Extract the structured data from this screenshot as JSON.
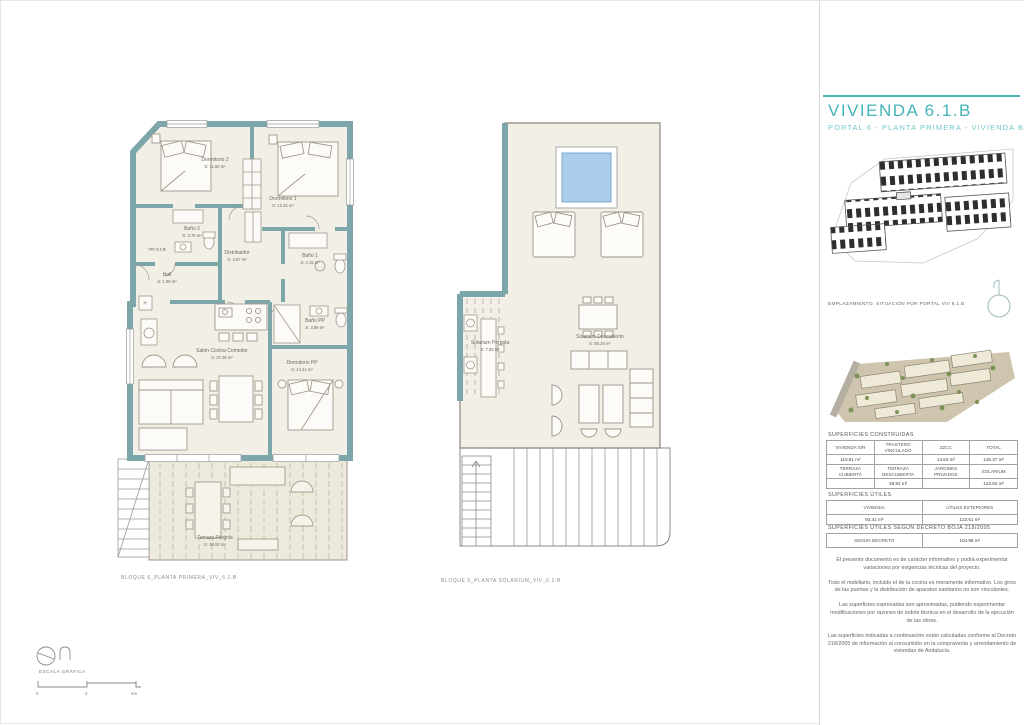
{
  "header": {
    "title": "VIVIENDA 6.1.B",
    "subtitle": "PORTAL 6 - PLANTA PRIMERA - VIVIENDA B"
  },
  "siteplan": {
    "caption": "EMPLAZAMIENTO. SITUACIÓN POR PORTAL VIV 6.1.B"
  },
  "areas": {
    "constructed_title": "SUPERFICIES CONSTRUIDAS",
    "table1": {
      "h": [
        "VIVIENDA S/R",
        "TRASTERO VINCULADO",
        "ZZCC",
        "TOTAL"
      ],
      "v": [
        "110.61 m²",
        "",
        "13.63 m²",
        "125.37 m²"
      ]
    },
    "table2": {
      "h": [
        "TERRAZA CUBIERTA",
        "TERRAZA DESCUBIERTA",
        "JARDINES PRIVADOS",
        "SOLARIUM"
      ],
      "v": [
        "",
        "38.92 m²",
        "",
        "122.82 m²"
      ]
    },
    "useful_title": "SUPERFICIES ÚTILES",
    "table3": {
      "h": [
        "VIVIENDA",
        "ÚTILES EXTERIORES"
      ],
      "v": [
        "93.41 m²",
        "123.61 m²"
      ]
    },
    "decree_title": "SUPERFICIES ÚTILES SEGÚN DECRETO BOJA 218/2005",
    "table4": {
      "h": [
        "SEGÚN DECRETO"
      ],
      "v": [
        "104.95 m²"
      ]
    }
  },
  "disclaimers": [
    "El presente documento es de carácter informativo y podrá experimentar variaciones por exigencias técnicas del proyecto.",
    "Todo el mobiliario, incluido el de la cocina es meramente informativo. Los giros de las puertas y la distribución de aparatos sanitarios no son vinculantes.",
    "Las superficies expresadas son aproximadas, pudiendo experimentar modificaciones por razones de índole técnica en el desarrollo de la ejecución de las obras.",
    "Las superficies indicadas a continuación están calculadas conforme al Decreto 218/2005 de información al consumidor en la compraventa y arrendamiento de viviendas de Andalucía."
  ],
  "plan_first": {
    "caption": "BLOQUE 6_PLANTA PRIMERA_VIV_6.1.B",
    "unit": "VIV. 6.1.B",
    "shaft": "H",
    "rooms": [
      {
        "name": "Dormitorio 2",
        "area": "S: 11.60 m²"
      },
      {
        "name": "Dormitorio 1",
        "area": "S: 12.34 m²"
      },
      {
        "name": "Baño 2",
        "area": "S: 3.76 m²"
      },
      {
        "name": "Baño 1",
        "area": "S: 4.15 m²"
      },
      {
        "name": "Distribuidor",
        "area": "S: 3.97 m²"
      },
      {
        "name": "Hall",
        "area": "S: 1.99 m²"
      },
      {
        "name": "Baño PP",
        "area": "S: 3.99 m²"
      },
      {
        "name": "Salón Cocina Comedor",
        "area": "S: 37.36 m²"
      },
      {
        "name": "Dormitorio PP",
        "area": "S: 14.41 m²"
      },
      {
        "name": "Terraza Pérgola",
        "area": "S: 38.92 m²"
      }
    ]
  },
  "plan_solarium": {
    "caption": "BLOQUE 6_PLANTA SOLARIUM_VIV_6.1.B",
    "rooms": [
      {
        "name": "Solarium Descubierto",
        "area": "S: 86.25 m²"
      },
      {
        "name": "Solarium Pérgola",
        "area": "S: 7.93 m²"
      }
    ]
  },
  "footer": {
    "scale_label": "ESCALA GRÁFICA",
    "ticks": [
      "0",
      "2",
      "4m"
    ]
  },
  "colors": {
    "accent_teal": "#4cb5b9",
    "wall_teal": "#7da6aa",
    "pool_blue": "#a9cdea",
    "floor_beige": "#f2efe7"
  }
}
